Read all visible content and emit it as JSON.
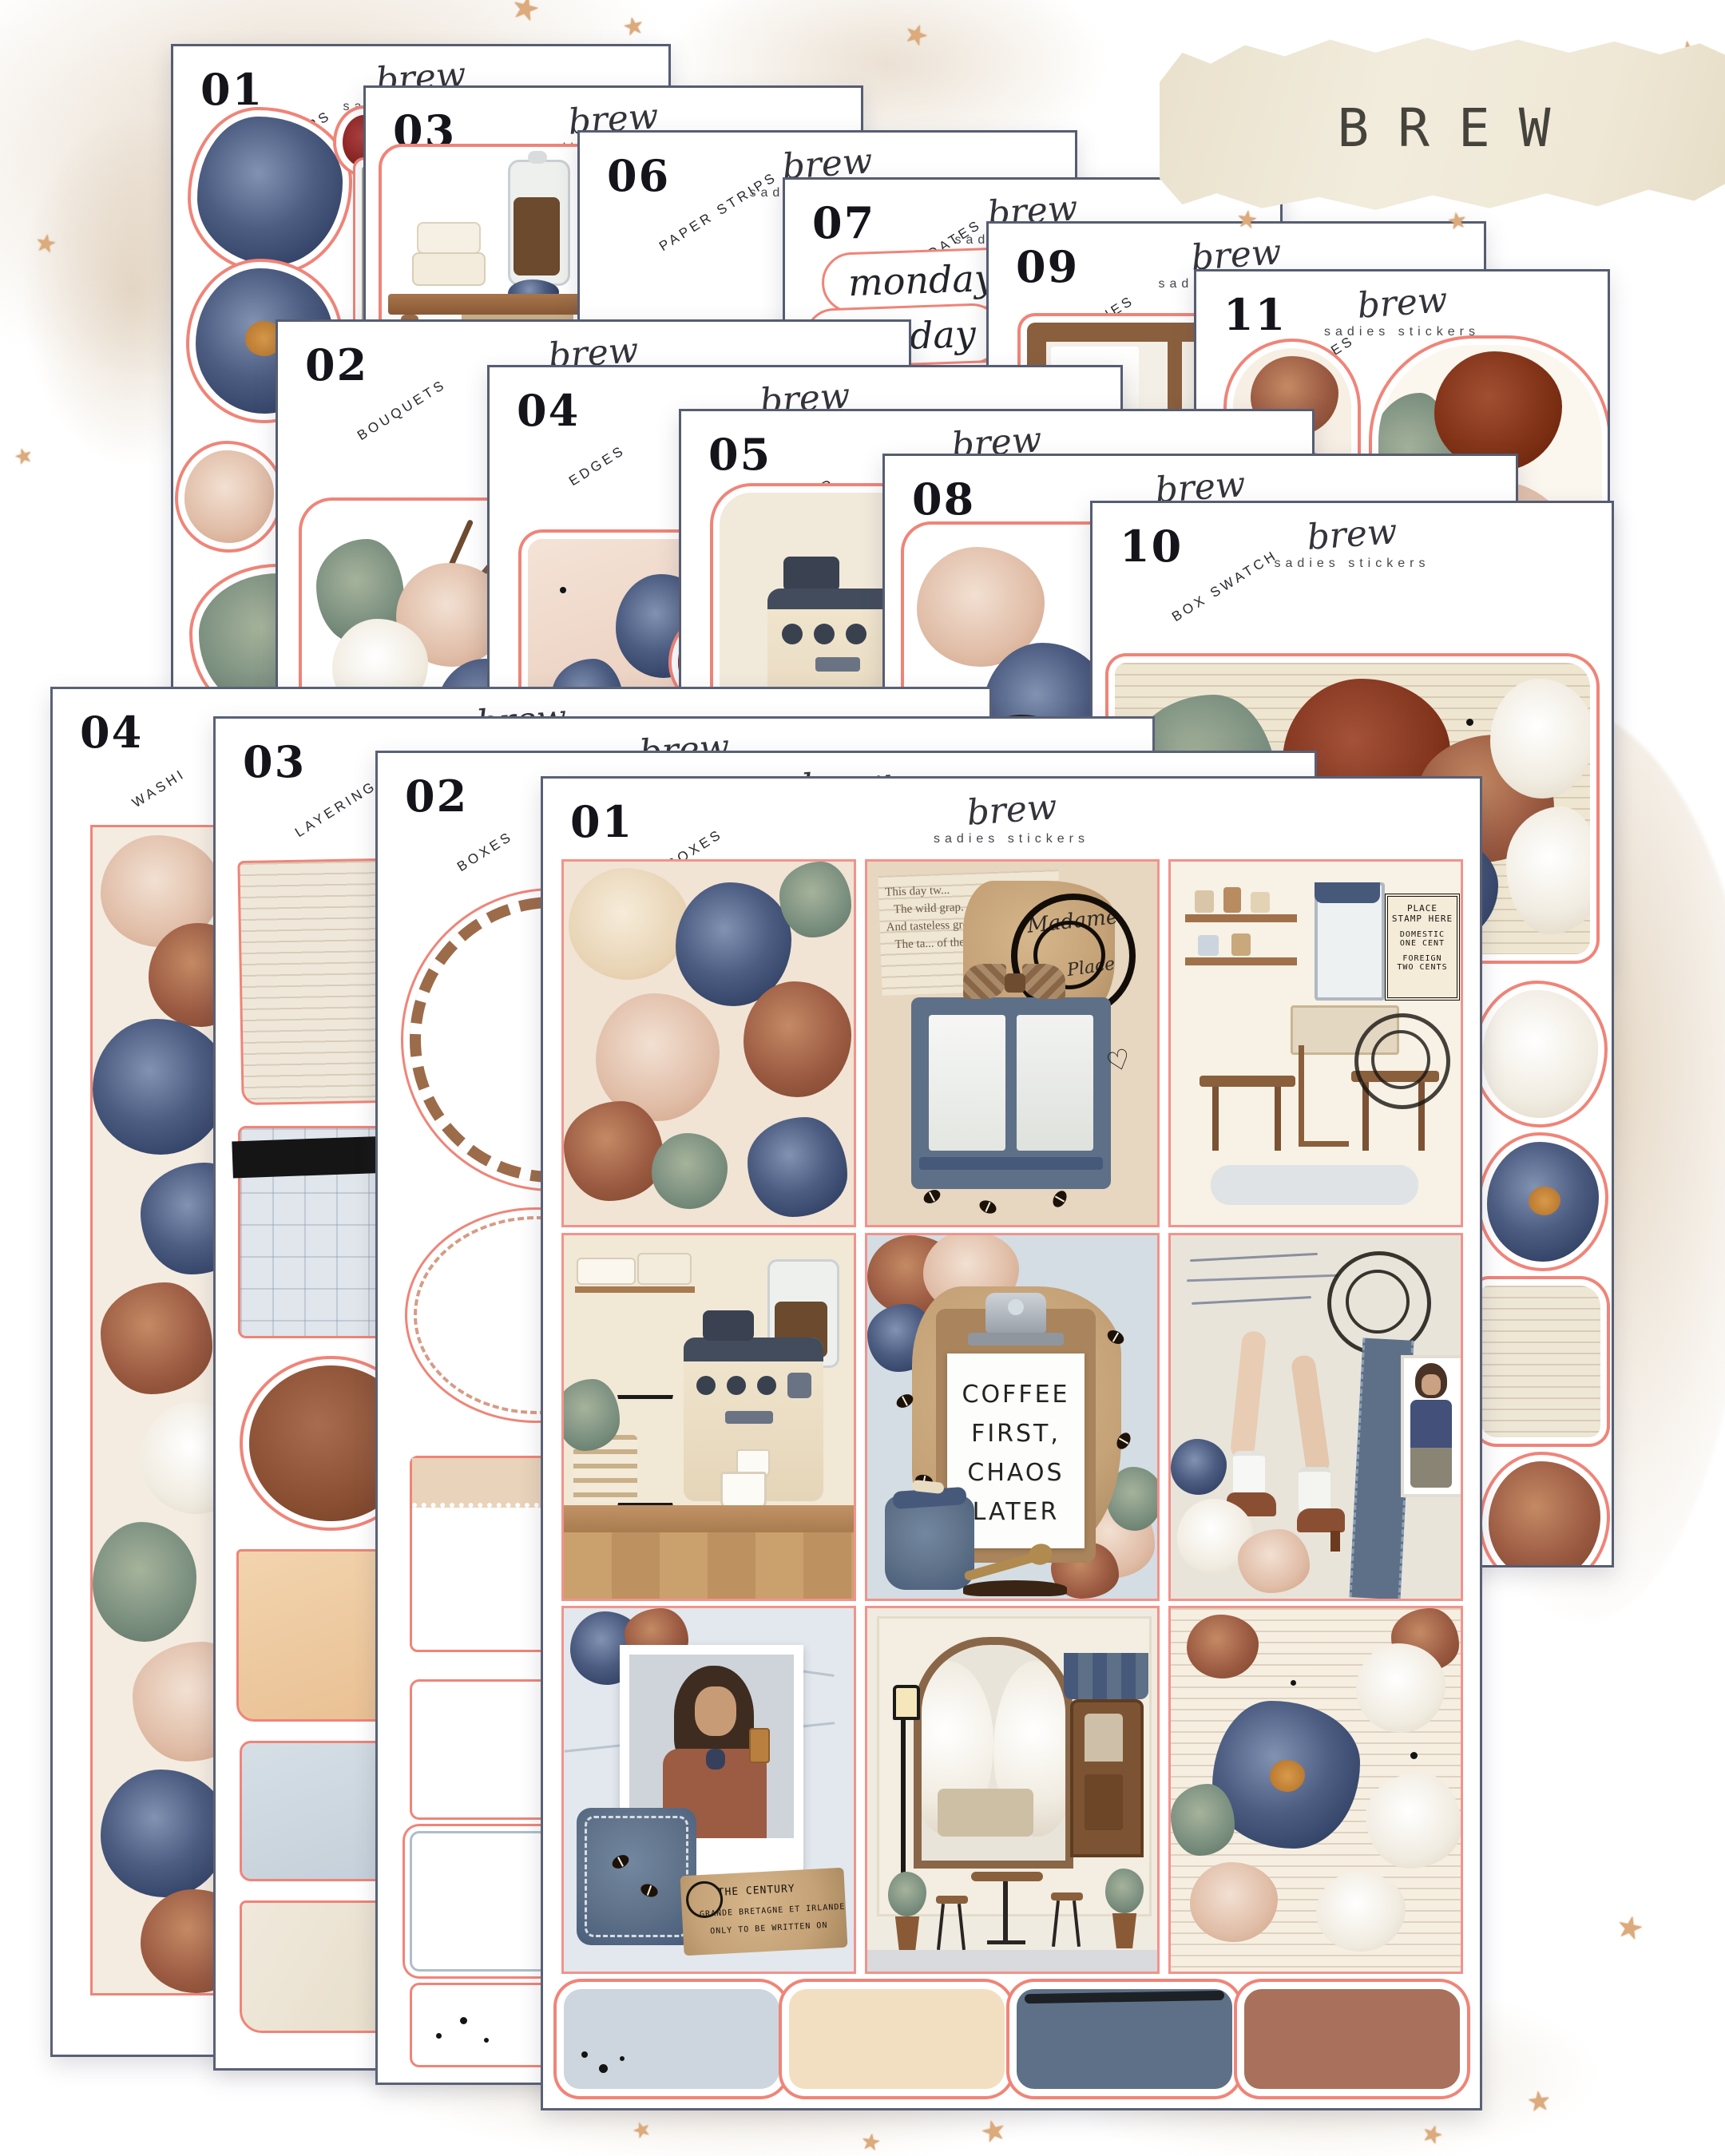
{
  "title": "BREW",
  "brand": {
    "script": "brew",
    "name": "sadies stickers"
  },
  "sheets": [
    {
      "num": "01",
      "label": "FLOWERS"
    },
    {
      "num": "03",
      "label": "ELEMENTS"
    },
    {
      "num": "06",
      "label": "PAPER STRIPS"
    },
    {
      "num": "07",
      "label": "DAYS & DATES"
    },
    {
      "num": "09",
      "label": "SCENES"
    },
    {
      "num": "11",
      "label": "SWASHES"
    },
    {
      "num": "02",
      "label": "BOUQUETS"
    },
    {
      "num": "04",
      "label": "EDGES"
    },
    {
      "num": "05",
      "label": "LAYERED"
    },
    {
      "num": "08",
      "label": "BORDERS"
    },
    {
      "num": "10",
      "label": "BOX SWATCH"
    },
    {
      "num": "04",
      "label": "WASHI"
    },
    {
      "num": "03",
      "label": "LAYERING"
    },
    {
      "num": "02",
      "label": "BOXES"
    },
    {
      "num": "01",
      "label": "FULL BOXES"
    }
  ],
  "days": [
    "monday",
    "tuesday",
    "wednesday"
  ],
  "clipboard": {
    "line1": "COFFEE",
    "line2": "FIRST,",
    "line3": "CHAOS",
    "line4": "LATER"
  },
  "stamp": {
    "line1": "PLACE",
    "line2": "STAMP HERE",
    "line3": "DOMESTIC",
    "line4": "ONE CENT",
    "line5": "FOREIGN",
    "line6": "TWO CENTS"
  },
  "poem": {
    "line1": "This day tw...",
    "line2": "The wild grap.",
    "line3": "And tasteless grou...",
    "line4": "The ta... of the woo..."
  },
  "script_words": {
    "word1": "Madame",
    "word2": "Place",
    "word3": "Andre"
  },
  "kraft_label": {
    "line1": "THE CENTURY",
    "line2": "GRANDE BRETAGNE ET IRLANDE",
    "line3": "ONLY TO BE WRITTEN ON"
  },
  "colors": {
    "accent_red": "#f08478",
    "sheet_border": "#565d72",
    "navy": "#41507a",
    "rust": "#9c5b43",
    "swatch1": "#cdd6de",
    "swatch2": "#f2dfc2",
    "swatch3": "#5d7087",
    "swatch4": "#a9705c"
  }
}
